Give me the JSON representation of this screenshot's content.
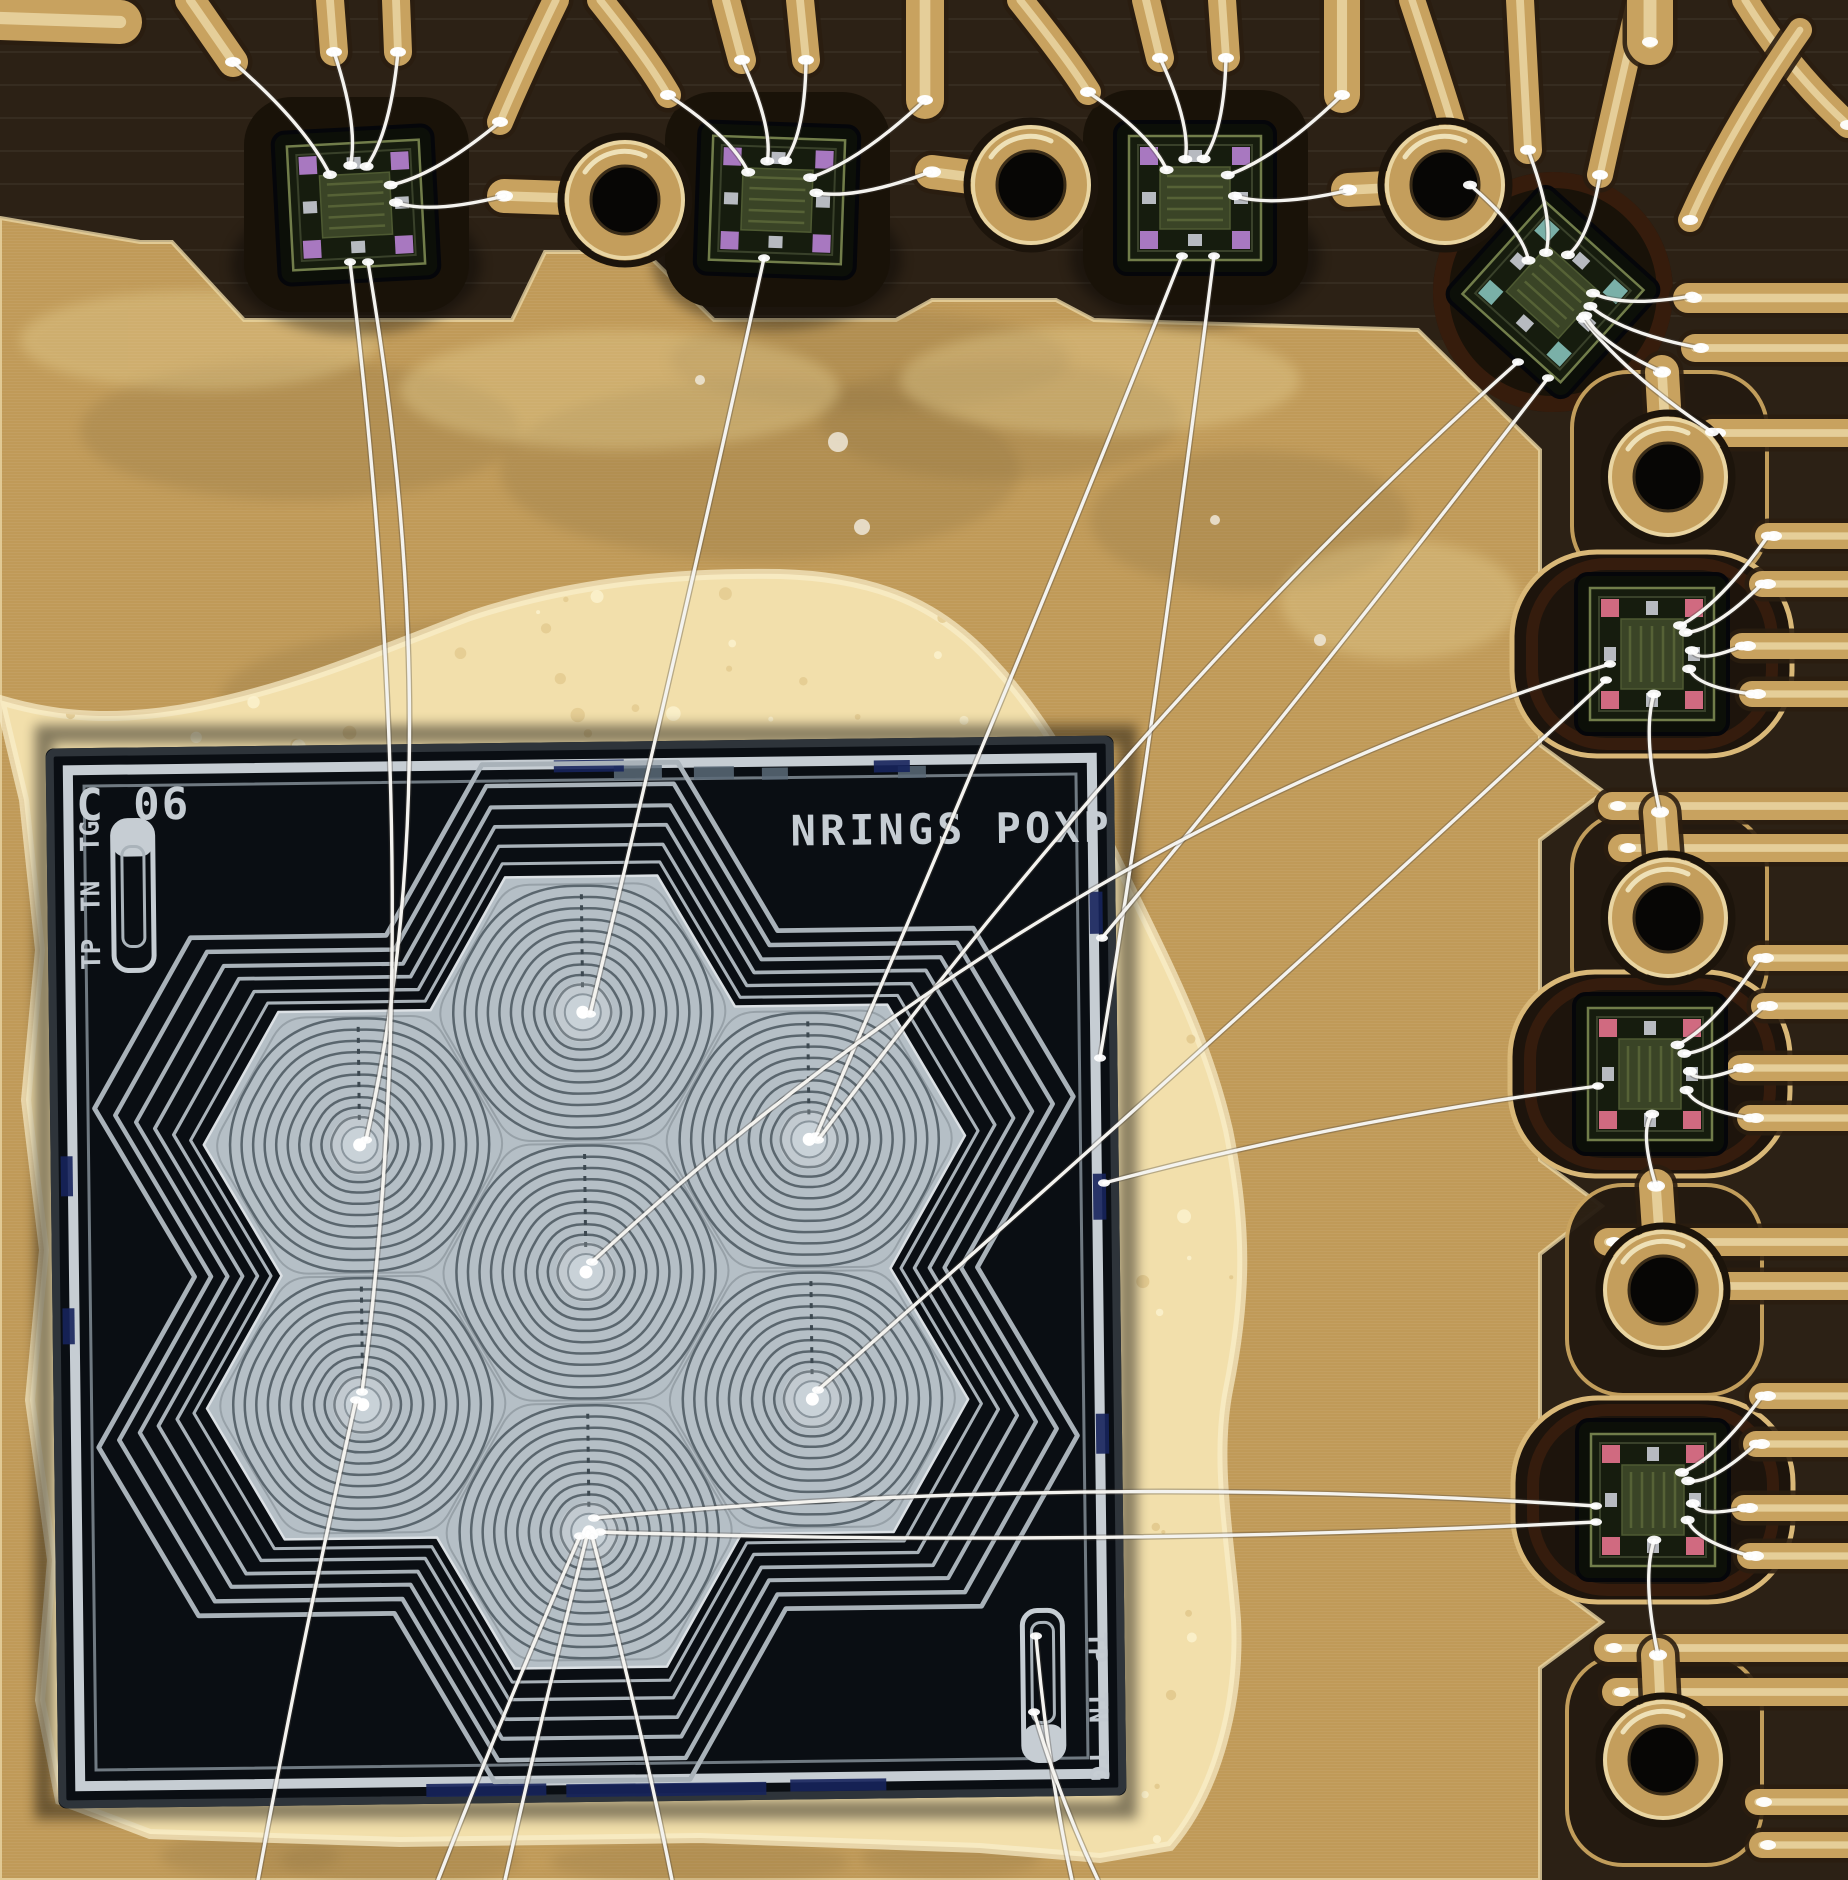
{
  "meta": {
    "type": "macro-photograph",
    "subject": "wire-bonded test die and sensor chips on gold-plated PCB",
    "image_width": 1848,
    "image_height": 1880
  },
  "die": {
    "id_label": "C 06",
    "title_label": "NRINGS POXP",
    "alignment_labels": [
      "TG",
      "TN",
      "TP"
    ],
    "alignment_labels_br": [
      "TP",
      "TN",
      "TG"
    ],
    "x": 52,
    "y": 742,
    "width": 1068,
    "height": 1060,
    "tilt_deg": -0.7
  },
  "colors": {
    "board_dark": "#332718",
    "band_dark": "#2c2115",
    "pocket_dark": "#191208",
    "glue_red": "#46220f",
    "gold_plane": "#c09a58",
    "gold_trace": "#c8a25f",
    "trace_dark": "#2a1d10",
    "trace_hi": "#ecdaa8",
    "gold_bright": "#e9d5a2",
    "adhesive": "#f2dfab",
    "adhesive_hi": "#faeecb",
    "die_bg": "#0a0e13",
    "die_silver": "#c6cdd3",
    "die_frame_mid": "#707a82",
    "hex_fill": "#b5bfc6",
    "hex_ring": "#5a666e",
    "hex_seam": "#97a1a8",
    "contour": "#a9b2b9",
    "wire": "#f4f3ef",
    "hole": "#070605",
    "mark_blue": "#16245c",
    "mark_gray": "#5a6a78",
    "chip_body": "#0c0f08",
    "chip_face": "#161c0e",
    "chip_block": "#3a4426"
  },
  "flower": {
    "center_x": 586,
    "center_y": 1272,
    "hex_radius": 150,
    "cell_offsets": [
      [
        0,
        0
      ],
      [
        0,
        -259.8
      ],
      [
        224.8,
        -129.9
      ],
      [
        224.8,
        129.9
      ],
      [
        0,
        259.8
      ],
      [
        -224.8,
        129.9
      ],
      [
        -224.8,
        -129.9
      ]
    ],
    "ring_radii": [
      146,
      133,
      120,
      107,
      94,
      81,
      68,
      55,
      43,
      32
    ],
    "contour_scales": [
      1.05,
      1.095,
      1.145,
      1.195,
      1.25,
      1.305
    ]
  },
  "chips": [
    {
      "x": 356,
      "y": 205,
      "rot": -3,
      "pad": "#a878c0",
      "fan": [
        [
          233,
          62
        ],
        [
          334,
          52
        ],
        [
          398,
          52
        ],
        [
          500,
          122
        ],
        [
          504,
          196
        ]
      ]
    },
    {
      "x": 777,
      "y": 200,
      "rot": 2,
      "pad": "#a878c0",
      "fan": [
        [
          668,
          95
        ],
        [
          742,
          60
        ],
        [
          806,
          60
        ],
        [
          925,
          100
        ],
        [
          930,
          172
        ]
      ]
    },
    {
      "x": 1195,
      "y": 198,
      "rot": 0,
      "pad": "#a878c0",
      "fan": [
        [
          1088,
          92
        ],
        [
          1160,
          58
        ],
        [
          1226,
          58
        ],
        [
          1342,
          95
        ],
        [
          1350,
          190
        ]
      ]
    },
    {
      "x": 1553,
      "y": 292,
      "rot": 42,
      "pad": "#7ab0a8",
      "fan": [
        [
          1470,
          185
        ],
        [
          1528,
          150
        ],
        [
          1600,
          175
        ],
        [
          1692,
          296
        ],
        [
          1700,
          348
        ],
        [
          1712,
          432
        ],
        [
          1662,
          372
        ]
      ]
    },
    {
      "x": 1652,
      "y": 654,
      "rot": 90,
      "pad": "#d06a80",
      "fan": [
        [
          1768,
          536
        ],
        [
          1762,
          584
        ],
        [
          1742,
          646
        ],
        [
          1752,
          694
        ],
        [
          1660,
          812
        ]
      ]
    },
    {
      "x": 1650,
      "y": 1074,
      "rot": 90,
      "pad": "#d06a80",
      "fan": [
        [
          1760,
          958
        ],
        [
          1764,
          1006
        ],
        [
          1740,
          1068
        ],
        [
          1750,
          1118
        ],
        [
          1656,
          1186
        ]
      ]
    },
    {
      "x": 1653,
      "y": 1500,
      "rot": 90,
      "pad": "#d06a80",
      "fan": [
        [
          1762,
          1396
        ],
        [
          1756,
          1444
        ],
        [
          1744,
          1508
        ],
        [
          1750,
          1556
        ],
        [
          1658,
          1655
        ]
      ]
    }
  ],
  "teardrops": [
    {
      "x": 625,
      "y": 200,
      "tip": [
        504,
        196
      ]
    },
    {
      "x": 1031,
      "y": 185,
      "tip": [
        932,
        172
      ]
    },
    {
      "x": 1445,
      "y": 185,
      "tip": [
        1348,
        190
      ]
    },
    {
      "x": 1668,
      "y": 477,
      "tip": [
        1662,
        372
      ]
    },
    {
      "x": 1668,
      "y": 918,
      "tip": [
        1660,
        812
      ]
    },
    {
      "x": 1663,
      "y": 1290,
      "tip": [
        1656,
        1186
      ]
    },
    {
      "x": 1663,
      "y": 1760,
      "tip": [
        1658,
        1655
      ]
    }
  ],
  "traces": [
    {
      "pts": [
        [
          0,
          18
        ],
        [
          120,
          22
        ]
      ],
      "w": 44
    },
    {
      "pts": [
        [
          190,
          0
        ],
        [
          233,
          62
        ]
      ],
      "w": 30
    },
    {
      "pts": [
        [
          330,
          0
        ],
        [
          334,
          52
        ]
      ],
      "w": 28
    },
    {
      "pts": [
        [
          396,
          0
        ],
        [
          398,
          52
        ]
      ],
      "w": 28
    },
    {
      "pts": [
        [
          556,
          0
        ],
        [
          522,
          70
        ],
        [
          500,
          122
        ]
      ],
      "w": 26
    },
    {
      "pts": [
        [
          600,
          0
        ],
        [
          648,
          60
        ],
        [
          668,
          95
        ]
      ],
      "w": 26
    },
    {
      "pts": [
        [
          726,
          0
        ],
        [
          742,
          60
        ]
      ],
      "w": 28
    },
    {
      "pts": [
        [
          800,
          0
        ],
        [
          806,
          60
        ]
      ],
      "w": 28
    },
    {
      "pts": [
        [
          925,
          0
        ],
        [
          925,
          100
        ]
      ],
      "w": 38
    },
    {
      "pts": [
        [
          1020,
          0
        ],
        [
          1068,
          60
        ],
        [
          1088,
          92
        ]
      ],
      "w": 26
    },
    {
      "pts": [
        [
          1146,
          0
        ],
        [
          1160,
          58
        ]
      ],
      "w": 28
    },
    {
      "pts": [
        [
          1222,
          0
        ],
        [
          1226,
          58
        ]
      ],
      "w": 28
    },
    {
      "pts": [
        [
          1342,
          0
        ],
        [
          1342,
          95
        ]
      ],
      "w": 36
    },
    {
      "pts": [
        [
          1412,
          0
        ],
        [
          1452,
          120
        ],
        [
          1470,
          185
        ]
      ],
      "w": 26
    },
    {
      "pts": [
        [
          1520,
          0
        ],
        [
          1528,
          150
        ]
      ],
      "w": 28
    },
    {
      "pts": [
        [
          1640,
          0
        ],
        [
          1612,
          120
        ],
        [
          1600,
          175
        ]
      ],
      "w": 26
    },
    {
      "pts": [
        [
          1650,
          0
        ],
        [
          1650,
          42
        ]
      ],
      "w": 46
    },
    {
      "pts": [
        [
          1745,
          0
        ],
        [
          1788,
          70
        ],
        [
          1848,
          125
        ]
      ],
      "w": 26
    },
    {
      "pts": [
        [
          1800,
          30
        ],
        [
          1730,
          130
        ],
        [
          1690,
          220
        ]
      ],
      "w": 24
    }
  ],
  "fingers": [
    {
      "y": 298,
      "tip": 1688,
      "w": 30
    },
    {
      "y": 348,
      "tip": 1695,
      "w": 28
    },
    {
      "y": 433,
      "tip": 1712,
      "w": 28
    },
    {
      "y": 536,
      "tip": 1768,
      "w": 26
    },
    {
      "y": 584,
      "tip": 1762,
      "w": 26
    },
    {
      "y": 646,
      "tip": 1742,
      "w": 26
    },
    {
      "y": 694,
      "tip": 1752,
      "w": 26
    },
    {
      "y": 806,
      "tip": 1612,
      "w": 28
    },
    {
      "y": 848,
      "tip": 1622,
      "w": 28
    },
    {
      "y": 958,
      "tip": 1760,
      "w": 26
    },
    {
      "y": 1006,
      "tip": 1764,
      "w": 26
    },
    {
      "y": 1068,
      "tip": 1740,
      "w": 26
    },
    {
      "y": 1118,
      "tip": 1750,
      "w": 26
    },
    {
      "y": 1242,
      "tip": 1608,
      "w": 28
    },
    {
      "y": 1286,
      "tip": 1618,
      "w": 28
    },
    {
      "y": 1396,
      "tip": 1762,
      "w": 26
    },
    {
      "y": 1444,
      "tip": 1756,
      "w": 26
    },
    {
      "y": 1508,
      "tip": 1744,
      "w": 26
    },
    {
      "y": 1556,
      "tip": 1750,
      "w": 26
    },
    {
      "y": 1648,
      "tip": 1608,
      "w": 28
    },
    {
      "y": 1692,
      "tip": 1616,
      "w": 28
    },
    {
      "y": 1802,
      "tip": 1758,
      "w": 26
    },
    {
      "y": 1845,
      "tip": 1762,
      "w": 26
    }
  ],
  "long_wires": [
    [
      [
        368,
        262
      ],
      [
        452,
        760
      ],
      [
        366,
        1140
      ]
    ],
    [
      [
        350,
        262
      ],
      [
        428,
        900
      ],
      [
        362,
        1392
      ]
    ],
    [
      [
        764,
        258
      ],
      [
        676,
        660
      ],
      [
        590,
        1014
      ]
    ],
    [
      [
        1182,
        256
      ],
      [
        1006,
        700
      ],
      [
        816,
        1136
      ]
    ],
    [
      [
        1214,
        256
      ],
      [
        1150,
        760
      ],
      [
        1100,
        1058
      ]
    ],
    [
      [
        1518,
        362
      ],
      [
        1160,
        680
      ],
      [
        818,
        1140
      ]
    ],
    [
      [
        1548,
        378
      ],
      [
        1300,
        700
      ],
      [
        1102,
        938
      ]
    ],
    [
      [
        1610,
        664
      ],
      [
        1060,
        830
      ],
      [
        592,
        1262
      ]
    ],
    [
      [
        1606,
        680
      ],
      [
        1240,
        1020
      ],
      [
        818,
        1390
      ]
    ],
    [
      [
        1598,
        1086
      ],
      [
        1340,
        1120
      ],
      [
        1104,
        1183
      ]
    ],
    [
      [
        1596,
        1506
      ],
      [
        1080,
        1472
      ],
      [
        594,
        1518
      ]
    ],
    [
      [
        1596,
        1522
      ],
      [
        1080,
        1548
      ],
      [
        600,
        1532
      ]
    ],
    [
      [
        588,
        1532
      ],
      [
        545,
        1700
      ],
      [
        505,
        1880
      ]
    ],
    [
      [
        580,
        1536
      ],
      [
        500,
        1720
      ],
      [
        438,
        1880
      ]
    ],
    [
      [
        592,
        1536
      ],
      [
        640,
        1720
      ],
      [
        672,
        1880
      ]
    ],
    [
      [
        1036,
        1636
      ],
      [
        1048,
        1770
      ],
      [
        1072,
        1880
      ]
    ],
    [
      [
        1034,
        1712
      ],
      [
        1060,
        1800
      ],
      [
        1098,
        1880
      ]
    ],
    [
      [
        356,
        1400
      ],
      [
        300,
        1650
      ],
      [
        258,
        1880
      ]
    ]
  ],
  "marks": {
    "gray": [
      [
        620,
        766,
        48,
        14
      ],
      [
        700,
        768,
        40,
        13
      ],
      [
        768,
        770,
        26,
        12
      ],
      [
        904,
        770,
        28,
        12
      ]
    ],
    "blue": [
      [
        420,
        1782,
        120,
        13
      ],
      [
        560,
        1784,
        200,
        13
      ],
      [
        784,
        1782,
        96,
        12
      ],
      [
        1094,
        898,
        13,
        42
      ],
      [
        1094,
        1180,
        13,
        46
      ],
      [
        1094,
        1420,
        13,
        40
      ],
      [
        62,
        1150,
        12,
        40
      ],
      [
        62,
        1302,
        12,
        36
      ],
      [
        560,
        760,
        70,
        12
      ],
      [
        880,
        764,
        36,
        12
      ]
    ]
  },
  "pale_dots": [
    [
      838,
      442,
      10
    ],
    [
      862,
      527,
      8
    ],
    [
      1320,
      640,
      6
    ],
    [
      700,
      380,
      5
    ],
    [
      1215,
      520,
      5
    ]
  ]
}
